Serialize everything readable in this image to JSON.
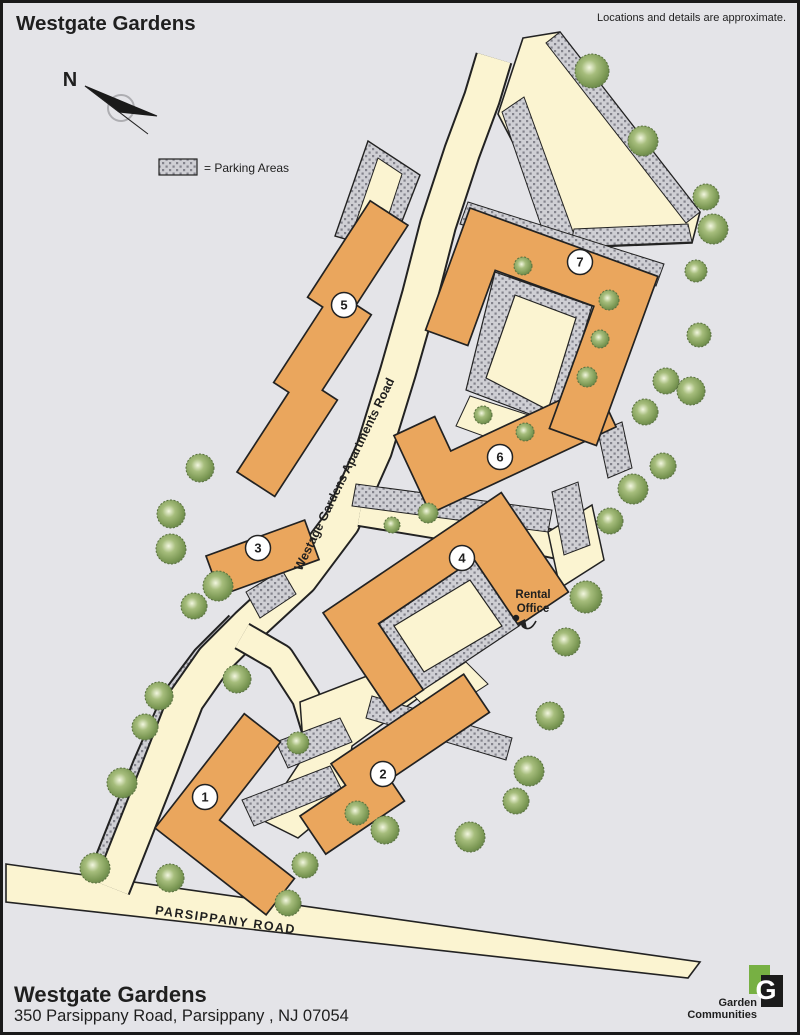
{
  "map": {
    "title": "Westgate Gardens",
    "disclaimer": "Locations and details are approximate.",
    "compass_label": "N",
    "legend_label": "= Parking Areas"
  },
  "roads": {
    "main": "Westage Gardens Apartments Road",
    "bottom": "PARSIPPANY ROAD"
  },
  "rental_office": {
    "line1": "Rental",
    "line2": "Office"
  },
  "buildings": [
    {
      "number": "1"
    },
    {
      "number": "2"
    },
    {
      "number": "3"
    },
    {
      "number": "4"
    },
    {
      "number": "5"
    },
    {
      "number": "6"
    },
    {
      "number": "7"
    }
  ],
  "footer": {
    "name": "Westgate Gardens",
    "address": "350 Parsippany Road, Parsippany , NJ 07054"
  },
  "logo": {
    "letter": "G",
    "line1": "Garden",
    "line2": "Communities"
  },
  "colors": {
    "background": "#E4E4E8",
    "road": "#FBF4D1",
    "building": "#EAA65D",
    "parking_base": "#CFCFD4",
    "parking_dot": "#83838C",
    "tree": "#7A9753",
    "logo_green": "#77B043",
    "outline": "#222222"
  }
}
